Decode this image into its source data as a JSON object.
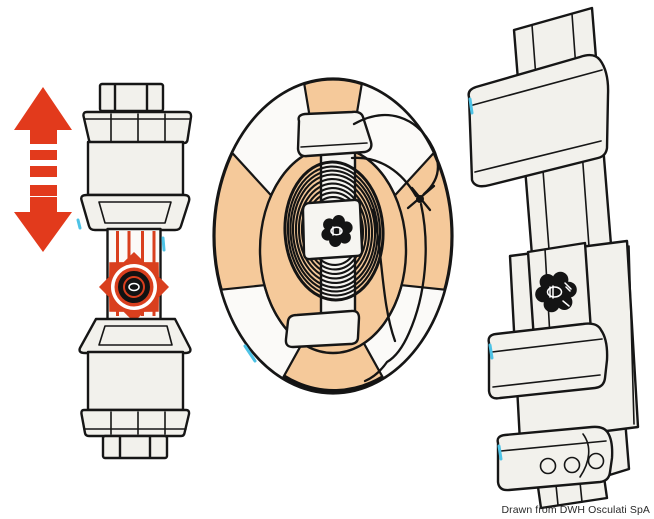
{
  "canvas": {
    "width_px": 654,
    "height_px": 519,
    "background": "#ffffff"
  },
  "caption": {
    "text": "Drawn from DWH Osculati SpA",
    "color": "#2a2a2a"
  },
  "colors": {
    "arrow_red": "#e23a1c",
    "knob_red": "#d93f1e",
    "buoy_peach": "#f5c99a",
    "outline": "#161616",
    "ink": "#141414",
    "panel_fill": "#f2f1ec",
    "plate_fill": "#f6f5f1",
    "white": "#ffffff",
    "scan_cyan": "#4ec3e6"
  },
  "parts": {
    "arrow_icon": "up-down-arrow",
    "left_view": "telescopic-pole-clamp-front-view",
    "left_highlight": "star-adjustment-knob-highlighted-red",
    "center_view": "lifebuoy-with-coiled-rope-front-view",
    "center_knob": "star-locking-knob",
    "right_view": "wall-mount-bracket-perspective-view",
    "right_knob": "star-locking-knob"
  }
}
